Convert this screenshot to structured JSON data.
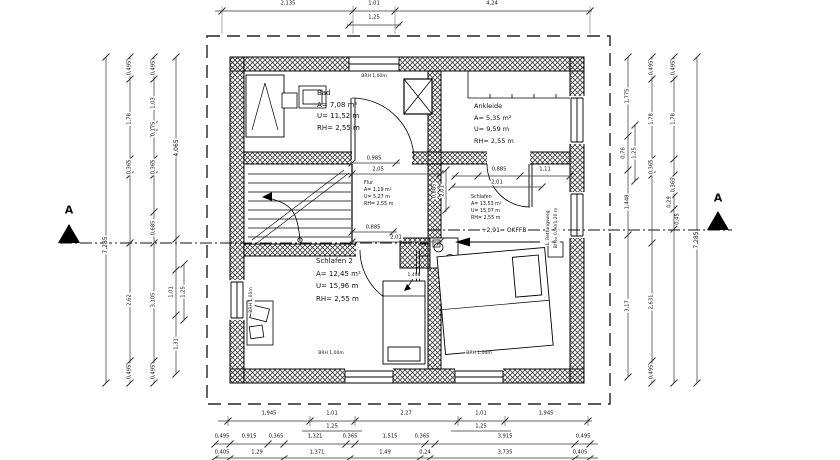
{
  "meta": {
    "background": "#ffffff",
    "ink": "#111111"
  },
  "section_markers": {
    "left": "A",
    "right": "A"
  },
  "window_sill_label": "BRH 1,00m",
  "level_marker": {
    "text": "+2,91= OKFFB"
  },
  "rescue_window": {
    "line1": "1. Rettungsweg",
    "line2": "B/H= 0,90/1,20 m"
  },
  "rooms": [
    {
      "id": "bad",
      "name": "Bad",
      "area": "A= 7,08 m²",
      "perimeter": "U= 11,52 m",
      "room_height": "RH= 2,55 m"
    },
    {
      "id": "ankleide",
      "name": "Ankleide",
      "area": "A= 5,35 m²",
      "perimeter": "U= 9,59 m",
      "room_height": "RH= 2,55 m"
    },
    {
      "id": "flur",
      "name": "Flur",
      "area": "A= 1,19 m²",
      "perimeter": "U= 5,27 m",
      "room_height": "RH= 2,55 m"
    },
    {
      "id": "schlafen",
      "name": "Schlafen",
      "area": "A= 13,53 m²",
      "perimeter": "U= 15,07 m",
      "room_height": "RH= 2,55 m"
    },
    {
      "id": "schlafen-2",
      "name": "Schlafen 2",
      "area": "A= 12,45 m²",
      "perimeter": "U= 15,96 m",
      "room_height": "RH= 2,55 m"
    }
  ],
  "dimensions": {
    "top": [
      {
        "t": "2,135",
        "x": 288,
        "y": 4
      },
      {
        "t": "1,01",
        "x": 374,
        "y": 4
      },
      {
        "t": "4,24",
        "x": 492,
        "y": 4
      },
      {
        "t": "1,25",
        "x": 374,
        "y": 18
      }
    ],
    "bottom_row1": [
      {
        "t": "1,945",
        "x": 269,
        "y": 414
      },
      {
        "t": "1,01",
        "x": 332,
        "y": 414
      },
      {
        "t": "2,27",
        "x": 406,
        "y": 414
      },
      {
        "t": "1,01",
        "x": 481,
        "y": 414
      },
      {
        "t": "1,945",
        "x": 546,
        "y": 414
      },
      {
        "t": "1,25",
        "x": 332,
        "y": 427
      },
      {
        "t": "1,25",
        "x": 481,
        "y": 427
      }
    ],
    "bottom_row2": [
      {
        "t": "0,495",
        "x": 222,
        "y": 437
      },
      {
        "t": "0,915",
        "x": 249,
        "y": 437
      },
      {
        "t": "0,365",
        "x": 276,
        "y": 437
      },
      {
        "t": "1,321",
        "x": 315,
        "y": 437
      },
      {
        "t": "0,365",
        "x": 350,
        "y": 437
      },
      {
        "t": "1,515",
        "x": 390,
        "y": 437
      },
      {
        "t": "0,365",
        "x": 422,
        "y": 437
      },
      {
        "t": "3,915",
        "x": 505,
        "y": 437
      },
      {
        "t": "0,495",
        "x": 583,
        "y": 437
      }
    ],
    "bottom_row3": [
      {
        "t": "0,405",
        "x": 222,
        "y": 453
      },
      {
        "t": "1,29",
        "x": 257,
        "y": 453
      },
      {
        "t": "1,371",
        "x": 317,
        "y": 453
      },
      {
        "t": "1,49",
        "x": 385,
        "y": 453
      },
      {
        "t": "0,24",
        "x": 425,
        "y": 453
      },
      {
        "t": "3,735",
        "x": 505,
        "y": 453
      },
      {
        "t": "0,405",
        "x": 580,
        "y": 453
      }
    ],
    "left": [
      {
        "t": "7,285",
        "x": 106,
        "y": 245,
        "r": -90,
        "s": 6
      },
      {
        "t": "0,495",
        "x": 130,
        "y": 68,
        "r": -90
      },
      {
        "t": "1,78",
        "x": 130,
        "y": 119,
        "r": -90
      },
      {
        "t": "0,365",
        "x": 130,
        "y": 167,
        "r": -90
      },
      {
        "t": "2,62",
        "x": 130,
        "y": 300,
        "r": -90
      },
      {
        "t": "0,495",
        "x": 130,
        "y": 372,
        "r": -90
      },
      {
        "t": "0,495",
        "x": 154,
        "y": 68,
        "r": -90
      },
      {
        "t": "1,03",
        "x": 154,
        "y": 103,
        "r": -90
      },
      {
        "t": "0,175",
        "x": 154,
        "y": 129,
        "r": -90
      },
      {
        "t": "0,365",
        "x": 154,
        "y": 167,
        "r": -90
      },
      {
        "t": "0,685",
        "x": 154,
        "y": 228,
        "r": -90
      },
      {
        "t": "3,105",
        "x": 154,
        "y": 300,
        "r": -90
      },
      {
        "t": "0,495",
        "x": 154,
        "y": 372,
        "r": -90
      },
      {
        "t": "4,065",
        "x": 177,
        "y": 148,
        "r": -90,
        "s": 6
      },
      {
        "t": "1,01",
        "x": 172,
        "y": 292,
        "r": -90
      },
      {
        "t": "1,25",
        "x": 184,
        "y": 292,
        "r": -90
      },
      {
        "t": "1,31",
        "x": 177,
        "y": 344,
        "r": -90
      }
    ],
    "right": [
      {
        "t": "1,775",
        "x": 628,
        "y": 96,
        "r": -90
      },
      {
        "t": "0,76",
        "x": 624,
        "y": 153,
        "r": -90
      },
      {
        "t": "1,25",
        "x": 635,
        "y": 153,
        "r": -90
      },
      {
        "t": "1,448",
        "x": 628,
        "y": 202,
        "r": -90
      },
      {
        "t": "3,17",
        "x": 628,
        "y": 306,
        "r": -90
      },
      {
        "t": "0,495",
        "x": 652,
        "y": 68,
        "r": -90
      },
      {
        "t": "1,78",
        "x": 652,
        "y": 119,
        "r": -90
      },
      {
        "t": "0,365",
        "x": 652,
        "y": 167,
        "r": -90
      },
      {
        "t": "2,631",
        "x": 652,
        "y": 302,
        "r": -90
      },
      {
        "t": "0,495",
        "x": 652,
        "y": 372,
        "r": -90
      },
      {
        "t": "0,495",
        "x": 674,
        "y": 68,
        "r": -90
      },
      {
        "t": "1,78",
        "x": 674,
        "y": 119,
        "r": -90
      },
      {
        "t": "0,365",
        "x": 674,
        "y": 185,
        "r": -90
      },
      {
        "t": "0,29",
        "x": 670,
        "y": 202,
        "r": -90
      },
      {
        "t": "0,45",
        "x": 678,
        "y": 219,
        "r": -90
      },
      {
        "t": "7,285",
        "x": 697,
        "y": 240,
        "r": -90,
        "s": 6
      }
    ],
    "interior": [
      {
        "t": "0,985",
        "x": 374,
        "y": 159
      },
      {
        "t": "2,05",
        "x": 378,
        "y": 170
      },
      {
        "t": "0,885",
        "x": 499,
        "y": 170
      },
      {
        "t": "1,11",
        "x": 545,
        "y": 170
      },
      {
        "t": "2,01",
        "x": 497,
        "y": 183
      },
      {
        "t": "0,885",
        "x": 435,
        "y": 191,
        "r": -90
      },
      {
        "t": "2,01",
        "x": 443,
        "y": 191,
        "r": -90
      },
      {
        "t": "0,885",
        "x": 373,
        "y": 228
      },
      {
        "t": "2,01",
        "x": 396,
        "y": 238
      },
      {
        "t": "1,498",
        "x": 414,
        "y": 276,
        "s": 4.5
      }
    ]
  }
}
